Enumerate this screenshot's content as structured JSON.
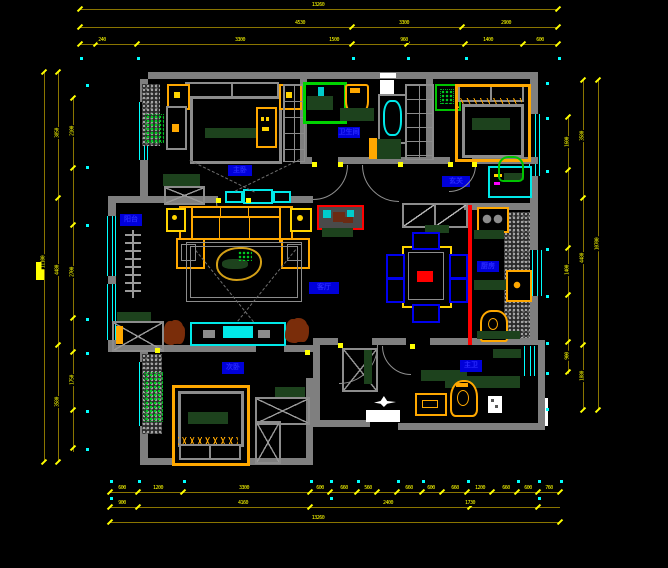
{
  "app": {
    "type": "cad-floor-plan",
    "background": "#000000"
  },
  "palette": {
    "wall": "#7f7f7f",
    "dim_line": "#8a7500",
    "dim_text": "#ffff00",
    "window": "#00ffff",
    "label_blue": "#0000d9",
    "furniture_orange": "#ffa800",
    "furniture_gray": "#8c8c8c",
    "accent_red": "#ff0000",
    "plant_green": "#00cc22",
    "counter_green": "#1d421d",
    "chair_blue": "#0000ee",
    "plant_brown": "#7a2d0a",
    "white": "#ffffff"
  },
  "rooms": {
    "master_bedroom": {
      "label": "主卧"
    },
    "bathroom": {
      "label": "卫生间"
    },
    "hall": {
      "label": "玄关"
    },
    "balcony": {
      "label": "阳台"
    },
    "living": {
      "label": "客厅"
    },
    "kitchen": {
      "label": "厨房"
    },
    "bedroom2": {
      "label": "次卧"
    },
    "bathroom2": {
      "label": "主卫"
    }
  },
  "annotations": {
    "logo_bar": " ",
    "north_icon": "north-arrow"
  },
  "plan": {
    "dims": {
      "h_rows": [
        {
          "y": 9,
          "x1": 80,
          "x2": 558,
          "ticks": [
            80,
            558
          ],
          "labels": [
            {
              "x": 318,
              "t": "13260"
            }
          ]
        },
        {
          "y": 27,
          "x1": 80,
          "x2": 558,
          "ticks": [
            80,
            352,
            462,
            558
          ],
          "labels": [
            {
              "x": 300,
              "t": "4530"
            },
            {
              "x": 404,
              "t": "3300"
            },
            {
              "x": 506,
              "t": "2900"
            }
          ]
        },
        {
          "y": 44,
          "x1": 80,
          "x2": 558,
          "ticks": [
            80,
            96,
            137,
            352,
            407,
            465,
            523,
            558
          ],
          "labels": [
            {
              "x": 102,
              "t": "240"
            },
            {
              "x": 240,
              "t": "3300"
            },
            {
              "x": 334,
              "t": "1500"
            },
            {
              "x": 404,
              "t": "960"
            },
            {
              "x": 488,
              "t": "1400"
            },
            {
              "x": 540,
              "t": "600"
            }
          ]
        },
        {
          "y": 492,
          "x1": 110,
          "x2": 560,
          "ticks": [
            110,
            138,
            183,
            310,
            330,
            357,
            377,
            397,
            422,
            442,
            467,
            492,
            517,
            538,
            560
          ],
          "labels": [
            {
              "x": 122,
              "t": "600"
            },
            {
              "x": 158,
              "t": "1200"
            },
            {
              "x": 244,
              "t": "3300"
            },
            {
              "x": 320,
              "t": "600"
            },
            {
              "x": 344,
              "t": "660"
            },
            {
              "x": 368,
              "t": "560"
            },
            {
              "x": 409,
              "t": "660"
            },
            {
              "x": 431,
              "t": "600"
            },
            {
              "x": 455,
              "t": "660"
            },
            {
              "x": 480,
              "t": "1200"
            },
            {
              "x": 506,
              "t": "660"
            },
            {
              "x": 528,
              "t": "600"
            },
            {
              "x": 549,
              "t": "760"
            }
          ]
        },
        {
          "y": 507,
          "x1": 110,
          "x2": 560,
          "ticks": [
            110,
            138,
            310,
            470,
            538
          ],
          "labels": [
            {
              "x": 122,
              "t": "900"
            },
            {
              "x": 243,
              "t": "4160"
            },
            {
              "x": 388,
              "t": "2400"
            },
            {
              "x": 470,
              "t": "1730"
            }
          ]
        },
        {
          "y": 522,
          "x1": 110,
          "x2": 560,
          "ticks": [
            110,
            560
          ],
          "labels": [
            {
              "x": 318,
              "t": "13260"
            }
          ]
        }
      ],
      "v_cols": [
        {
          "x": 44,
          "y1": 72,
          "y2": 462,
          "ticks": [
            72,
            462
          ],
          "labels": [
            {
              "y": 262,
              "t": "11100"
            }
          ]
        },
        {
          "x": 58,
          "y1": 72,
          "y2": 462,
          "ticks": [
            72,
            198,
            345,
            462
          ],
          "labels": [
            {
              "y": 133,
              "t": "3850"
            },
            {
              "y": 270,
              "t": "4480"
            },
            {
              "y": 402,
              "t": "3580"
            }
          ]
        },
        {
          "x": 73,
          "y1": 96,
          "y2": 452,
          "ticks": [
            98,
            168,
            225,
            318,
            352,
            410,
            448
          ],
          "labels": [
            {
              "y": 131,
              "t": "2100"
            },
            {
              "y": 272,
              "t": "2700"
            },
            {
              "y": 380,
              "t": "1750"
            }
          ]
        },
        {
          "x": 568,
          "y1": 115,
          "y2": 374,
          "ticks": [
            117,
            170,
            248,
            295,
            342,
            372
          ],
          "labels": [
            {
              "y": 142,
              "t": "1600"
            },
            {
              "y": 270,
              "t": "1400"
            },
            {
              "y": 356,
              "t": "900"
            }
          ]
        },
        {
          "x": 583,
          "y1": 80,
          "y2": 410,
          "ticks": [
            80,
            198,
            345,
            410
          ],
          "labels": [
            {
              "y": 136,
              "t": "3580"
            },
            {
              "y": 258,
              "t": "4480"
            },
            {
              "y": 376,
              "t": "1880"
            }
          ]
        },
        {
          "x": 598,
          "y1": 80,
          "y2": 410,
          "ticks": [
            80,
            410
          ],
          "labels": [
            {
              "y": 244,
              "t": "10700"
            }
          ]
        }
      ],
      "dots_cyan": [
        [
          80,
          57
        ],
        [
          137,
          57
        ],
        [
          352,
          57
        ],
        [
          407,
          57
        ],
        [
          465,
          57
        ],
        [
          558,
          57
        ],
        [
          86,
          84
        ],
        [
          86,
          166
        ],
        [
          86,
          224
        ],
        [
          86,
          318
        ],
        [
          86,
          352
        ],
        [
          86,
          410
        ],
        [
          86,
          448
        ],
        [
          546,
          82
        ],
        [
          546,
          117
        ],
        [
          546,
          170
        ],
        [
          546,
          248
        ],
        [
          546,
          295
        ],
        [
          546,
          342
        ],
        [
          546,
          372
        ],
        [
          546,
          408
        ],
        [
          110,
          480
        ],
        [
          138,
          480
        ],
        [
          183,
          480
        ],
        [
          310,
          480
        ],
        [
          330,
          480
        ],
        [
          357,
          480
        ],
        [
          397,
          480
        ],
        [
          422,
          480
        ],
        [
          467,
          480
        ],
        [
          517,
          480
        ],
        [
          538,
          480
        ],
        [
          560,
          480
        ],
        [
          110,
          497
        ],
        [
          330,
          497
        ],
        [
          538,
          497
        ]
      ],
      "dots_yellow": [
        [
          312,
          162
        ],
        [
          338,
          162
        ],
        [
          448,
          162
        ],
        [
          472,
          162
        ],
        [
          398,
          162
        ],
        [
          338,
          343
        ],
        [
          410,
          344
        ],
        [
          246,
          198
        ],
        [
          216,
          198
        ],
        [
          155,
          348
        ],
        [
          305,
          350
        ]
      ]
    }
  }
}
